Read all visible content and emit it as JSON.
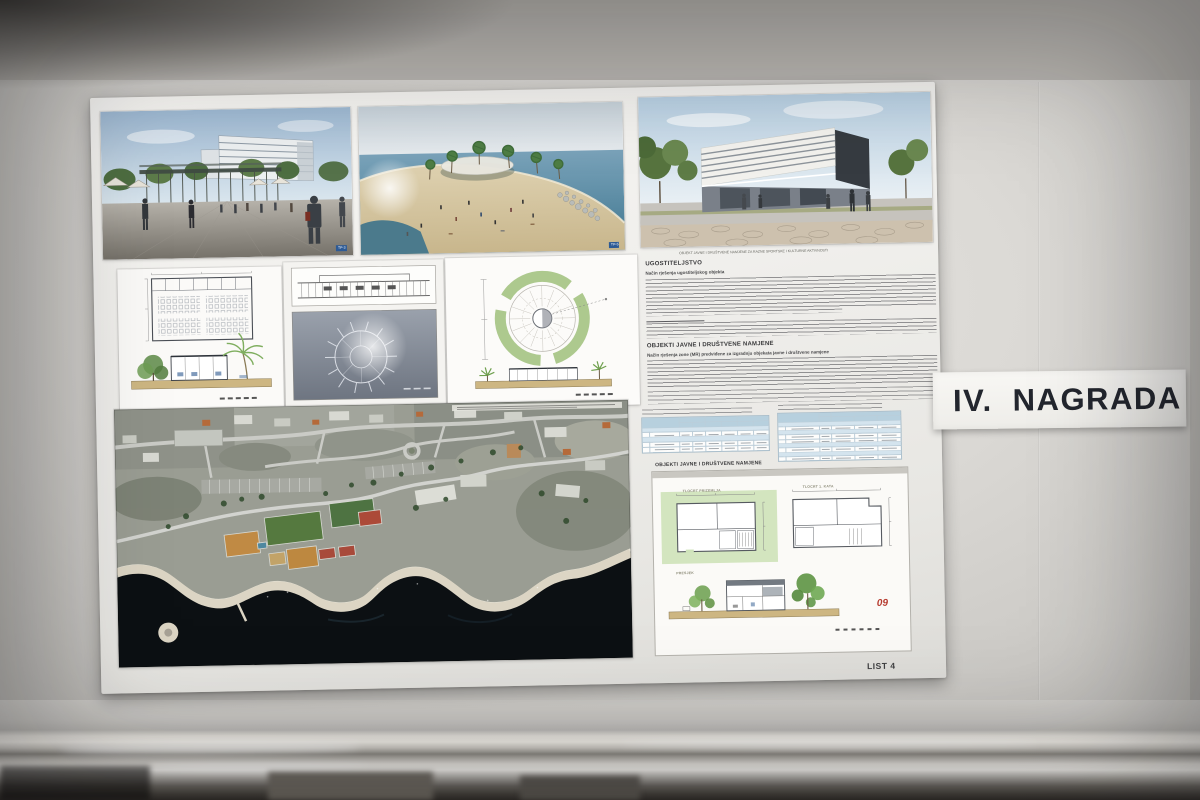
{
  "scene": {
    "description": "Photograph of an architectural competition presentation board displayed on an exhibition wall",
    "award_label": "IV. NAGRADA",
    "sheet_label": "LIST 4",
    "red_mark": "09"
  },
  "poster": {
    "renderings": {
      "plaza_tag": "TP-3",
      "beach_tag": "TP-5",
      "building_caption": "OBJEKT JAVNE I DRUŠTVENE NAMJENE ZA RAZNE SPORTSKE I KULTURNE AKTIVNOSTI"
    },
    "sections": {
      "s1_heading": "UGOSTITELJSTVO",
      "s1_subheading": "Način rješenja ugostiteljskog objekta",
      "s2_heading": "OBJEKTI JAVNE I DRUŠTVENE NAMJENE",
      "s2_subheading": "Način rješenja zone (MR) predviđene za izgradnju objekata javne i društvene namjene",
      "tables_heading": "OBJEKTI JAVNE I DRUŠTVENE NAMJENE"
    },
    "drawings": {
      "plan_ground_label": "TLOCRT PRIZEMLJA",
      "plan_first_label": "TLOCRT 1. KATA",
      "section_label": "PRESJEK"
    },
    "colors": {
      "award_text": "#23262e",
      "table_header": "#b7d0de",
      "landscape_green": "#adc98e",
      "ground_tan": "#cdb682",
      "sea_dark": "#0c1014",
      "red_mark": "#b63a2e"
    }
  }
}
